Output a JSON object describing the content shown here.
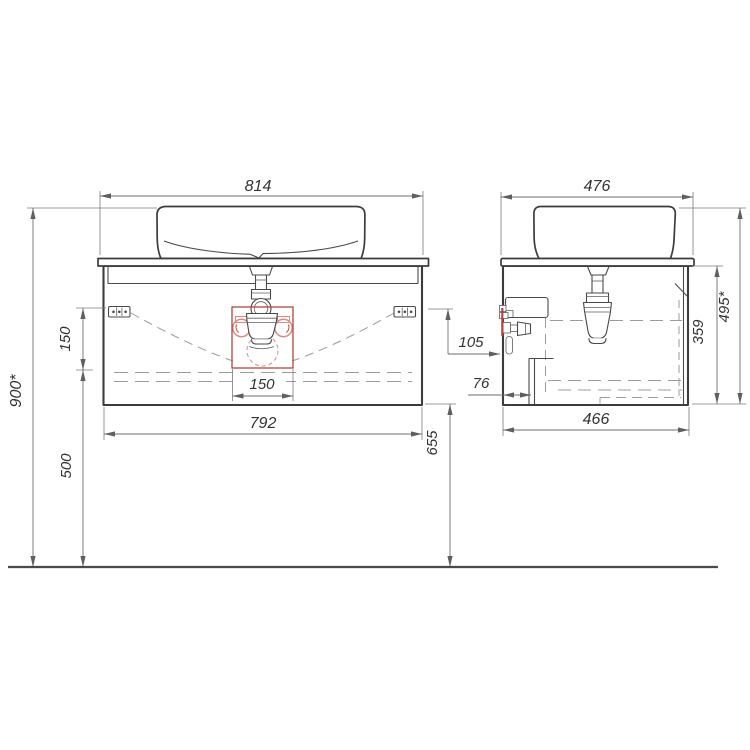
{
  "drawing": {
    "type": "technical-drawing",
    "subject": "wall-hung vanity cabinet with countertop vessel sink, front and side elevation views with installation dimensions (mm)",
    "front_view": {
      "dim_top_width": "814",
      "dim_cabinet_width": "792",
      "dim_drain_zone_width": "150",
      "dim_hinge_offset": "150",
      "dim_mount_height": "900*",
      "dim_under_clearance": "500",
      "dim_bottom_height": "655"
    },
    "side_view": {
      "dim_top_depth": "476",
      "dim_cabinet_depth": "466",
      "dim_cabinet_height": "359",
      "dim_overall_height": "495*",
      "dim_outlet_offset": "105",
      "dim_drawer_inset": "76"
    },
    "colors": {
      "outline": "#3c3c3c",
      "dimension": "#6e6e6e",
      "hidden_line": "#9b9b9b",
      "highlight_red": "#b0463f",
      "highlight_soft_red": "#d98b84"
    }
  }
}
